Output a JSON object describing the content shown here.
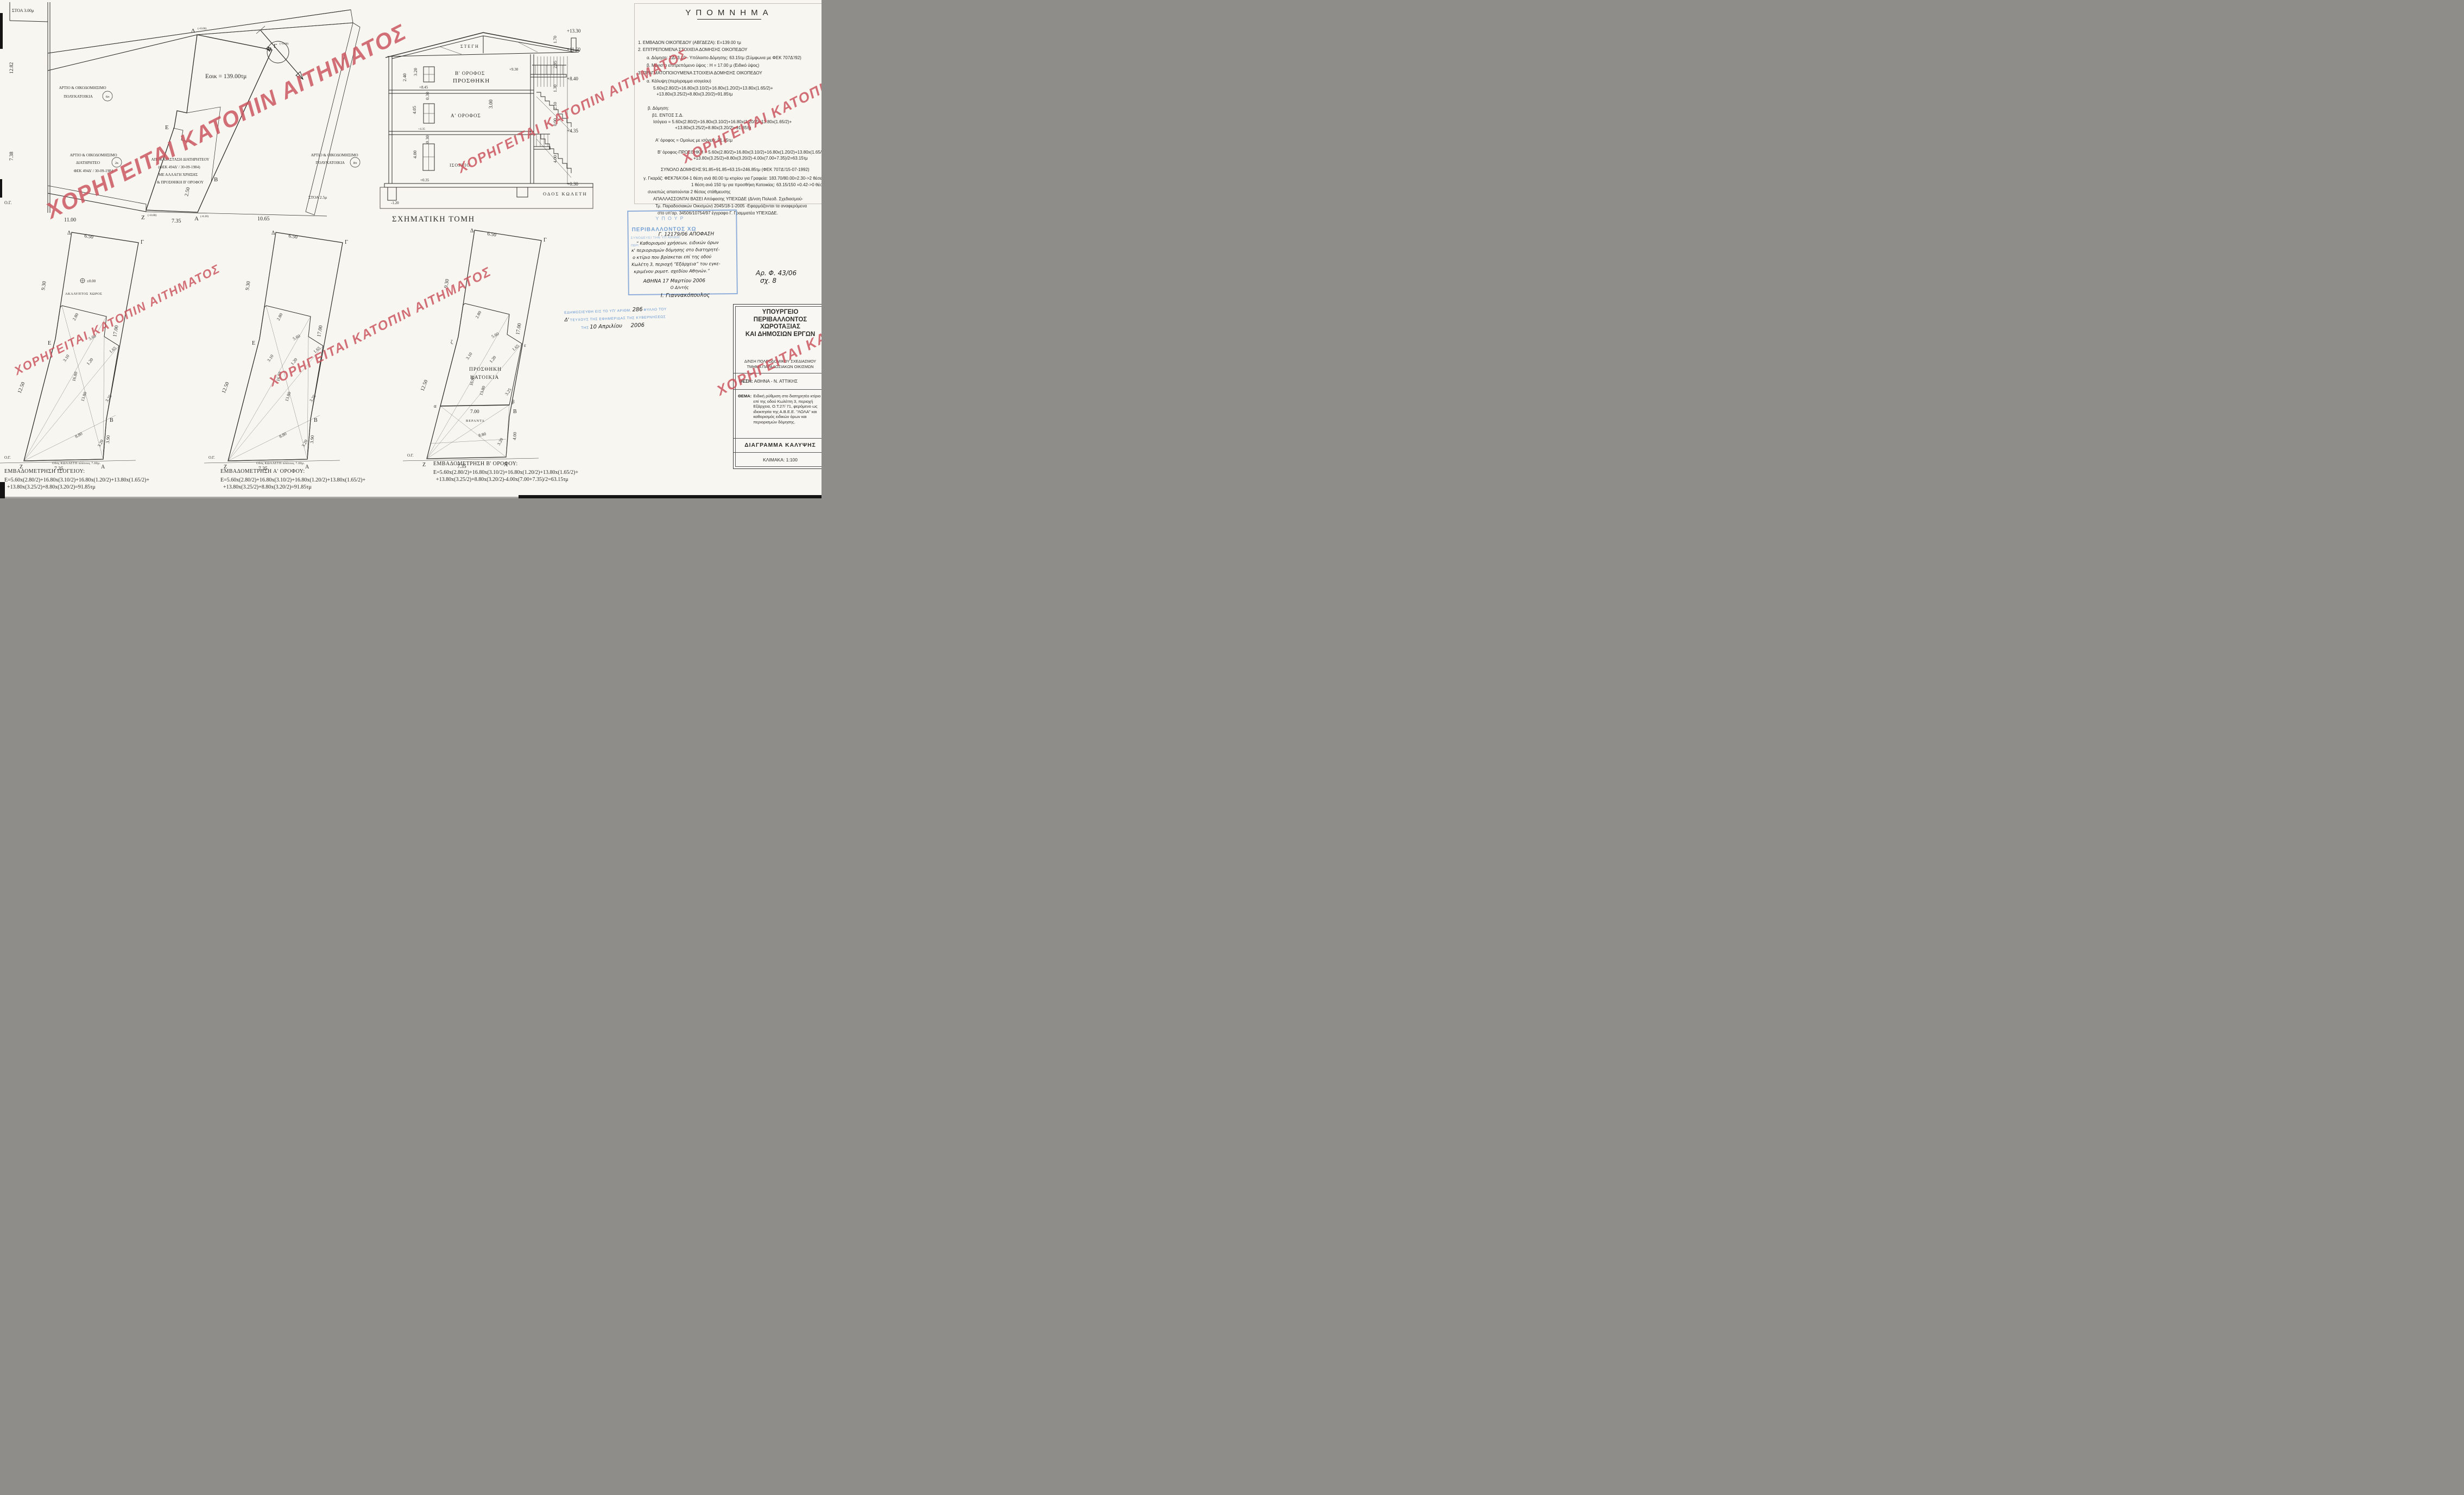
{
  "watermark": {
    "text": "ΧΟΡΗΓΕΙΤΑΙ ΚΑΤΟΠΙΝ ΑΙΤΗΜΑΤΟΣ",
    "color": "#c9515a"
  },
  "site_plan": {
    "stoa_top": "ΣΤΟΑ 3.00μ",
    "stoa_right": "ΣΤΟΑ 2.5μ",
    "building_line": "Ο.Γ.",
    "north": "Β",
    "area": "Εοικ = 139.00τμ",
    "dims": {
      "left_upper": "12.82",
      "left_lower": "7.38",
      "strip": "2.50",
      "bottom_left": "11.00",
      "bottom_mid": "7.35",
      "bottom_right": "10.65"
    },
    "corners": {
      "d": "Δ",
      "d_elev": "(+0.00)",
      "g": "Γ",
      "g_elev": "(+0.00)",
      "e": "Ε",
      "b": "Β",
      "z": "Ζ",
      "z_elev": "(+0.00)",
      "a": "Α",
      "a_elev": "(-0.20)"
    },
    "neighbor_top": {
      "l1": "ΑΡΤΙΟ & ΟΙΚΟΔΟΜΗΣΙΜΟ",
      "l2": "ΠΟΛΥΚΑΤΟΙΚΙΑ",
      "badge": "6π"
    },
    "neighbor_left": {
      "l1": "ΑΡΤΙΟ & ΟΙΚΟΔΟΜΗΣΙΜΟ",
      "l2": "ΔΙΑΤΗΡΗΤΕΟ",
      "badge": "2κ",
      "l3": "ΦΕΚ 494Δ' / 30-09-1984"
    },
    "neighbor_right": {
      "l1": "ΑΡΤΙΟ & ΟΙΚΟΔΟΜΗΣΙΜΟ",
      "l2": "ΠΟΛΥΚΑΤΟΙΚΙΑ",
      "badge": "8π"
    },
    "restoration": {
      "l1": "ΑΠΟΚΑΤΑΣΤΑΣΗ ΔΙΑΤΗΡΗΤΕΟΥ",
      "l2": "(ΦΕΚ 494Δ' / 30-09-1984)",
      "l3": "ΜΕ ΑΛΛΑΓΗ ΧΡΗΣΗΣ",
      "l4": "& ΠΡΟΣΘΗΚΗ Β' ΟΡΟΦΟΥ"
    }
  },
  "section": {
    "title": "ΣΧΗΜΑΤΙΚΗ ΤΟΜΗ",
    "roof": "ΣΤΕΓΗ",
    "floor2a": "Β' ΟΡΟΦΟΣ",
    "floor2b": "ΠΡΟΣΘΗΚΗ",
    "floor1": "Α' ΟΡΟΦΟΣ",
    "floor0": "ΙΣΟΓΕΙΟ",
    "street": "ΟΔΟΣ ΚΩΛΕΤΗ",
    "dims_left": [
      "2.40",
      "3.20",
      "0.30",
      "4.05",
      "0.30",
      "4.00"
    ],
    "elev_left": [
      "+8.45",
      "+4.35",
      "+0.35",
      "-1.20"
    ],
    "elev_right": [
      "+13.30",
      "+11.60",
      "+8.40",
      "+4.35",
      "+0.30"
    ],
    "dims_right": [
      "1.70",
      "2.95",
      "1.30",
      "2.10",
      "0.90",
      "4.00"
    ],
    "elev_stair": "+9.30",
    "dim_stair": "3.00"
  },
  "legend": {
    "title": "ΥΠΟΜΝΗΜΑ",
    "lines": [
      "1. ΕΜΒΑΔΟΝ ΟΙΚΟΠΕΔΟΥ (ΑΒΓΔΕΖΑ):   Ε=139.00 τμ",
      "2. ΕΠΙΤΡΕΠΟΜΕΝΑ ΣΤΟΙΧΕΙΑ ΔΟΜΗΣΗΣ ΟΙΚΟΠΕΔΟΥ",
      "α. Δόμηση: ΣΔ=3.10  - Υπόλοιπο Δόμησης: 63.15τμ (Σύμφωνα με ΦΕΚ 707Δ'/92)",
      "β. Μέγιστο επιτρεπόμενο ύψος : Η  = 17.00 μ (Ειδικό ύψος)",
      "3. ΠΡΑΓΜΑΤΟΠΟΙΟΥΜΕΝΑ ΣΤΟΙΧΕΙΑ ΔΟΜΗΣΗΣ ΟΙΚΟΠΕΔΟΥ",
      "α. Κάλυψη:(περίγραμμα ισογείου)",
      "5.60x(2.80/2)+16.80x(3.10/2)+16.80x(1.20/2)+13.80x(1.65/2)+",
      "+13.80x(3.25/2)+8.80x(3.20/2)=91.85τμ",
      "β. Δόμηση:",
      "β1. ΕΝΤΟΣ Σ.Δ.",
      "Ισόγειο = 5.60x(2.80/2)+16.80x(3.10/2)+16.80x(1.20/2)+13.80x(1.65/2)+",
      "+13.80x(3.25/2)+8.80x(3.20/2)=91.85τμ",
      "Α' όροφος = Ομοίως με ισόγειο:  91.85τμ",
      "Β' όροφος-ΠΡΟΣΘΗΚΗ = 5.60x(2.80/2)+16.80x(3.10/2)+16.80x(1.20/2)+13.80x(1.65/2)+",
      "+13.80x(3.25/2)+8.80x(3.20/2)-4.00x(7.00+7.35)/2=63.15τμ",
      "ΣΥΝΟΛΟ ΔΟΜΗΣΗΣ:91.85+91.85+63.15=246.85τμ   (ΦΕΚ 707Δ'/15-07-1992)",
      "γ. Γκαράζ: ΦΕΚ76Α'/04-1 θέση ανά 80.00 τμ κτιρίου για Γραφεία: 183.70/80.00=2.30->2 θέσεις",
      "1 θέση ανά 150 τμ για προσθήκη Κατοικίας: 63.15/150  =0.42->0 θέσεις",
      "συνεπώς απαιτούνται 2 θέσεις στάθμευσης",
      "ΑΠΑΛΛΑΣΣΟΝΤΑΙ ΒΑΣΕΙ Απόφασης ΥΠΕΧΩΔΕ (Δ/νση Πολεοδ. Σχεδιασμού-",
      "Τμ. Παραδοσιακών Οικισμών) 2045/18-1-2005 -Εφαρμόζονται τα αναφερόμενα",
      "στο υπ'αρ. 34506/10754/97 έγγραφο Γ. Γραμματέα ΥΠΕΧΩΔΕ."
    ]
  },
  "approval_stamp": {
    "printed": [
      "ΥΠΟΥΡ",
      "ΠΕΡΙΒΑΛΛΟΝΤΟΣ ΧΩ",
      "ΣΥΝΟΔΕΥΕΙ ΤΗΝ ΥΠ ΑΡΙΘΜ.",
      "ΠΕΡΙ"
    ],
    "hand": [
      "Γ. 12179/06 ΑΠΟΦΑΣΗ",
      "“ Καθορισμού χρήσεων, ειδικών όρων",
      "κ' περιορισμών δόμησης στο διατηρητέ-",
      "ο κτίριο που βρίσκεται επί της οδού",
      "Κωλέτη 3, περιοχή “Εξάρχεια” του εγκε-",
      "κριμένου ρυμοτ. σχεδίου Αθηνών.”",
      "ΑΘΗΝΑ 17 Μαρτίου 2006",
      "Ο Δ/ντής",
      "Ι. Γιαννακόπουλος"
    ]
  },
  "publication_stamp": {
    "printed": [
      "ΕΔΗΜΟΣΙΕΥΘΗ ΕΙΣ ΤΟ ΥΠ' ΑΡΙΘΜ.",
      "ΦΥΛΛΟ ΤΟΥ",
      "ΤΕΥΧΟΥΣ ΤΗΣ ΕΦΗΜΕΡΙΔΑΣ ΤΗΣ ΚΥΒΕΡΝΗΣΕΩΣ",
      "ΤΗΣ"
    ],
    "hand": [
      "286",
      "Δ'",
      "10 Απριλίου",
      "2006"
    ]
  },
  "file_note": {
    "l1": "Αρ. Φ. 43/06",
    "l2": "σχ. 8"
  },
  "title_block": {
    "ministry": [
      "ΥΠΟΥΡΓΕΙΟ",
      "ΠΕΡΙΒΑΛΛΟΝΤΟΣ",
      "ΧΩΡΟΤΑΞΙΑΣ",
      "ΚΑΙ ΔΗΜΟΣΙΩΝ ΕΡΓΩΝ"
    ],
    "department": [
      "Δ/ΝΣΗ ΠΟΛΕΟΔΟΜΙΚΟΥ ΣΧΕΔΙΑΣΜΟΥ",
      "ΤΜΗΜΑ ΠΑΡΑΔΟΣΙΑΚΩΝ ΟΙΚΙΣΜΩΝ"
    ],
    "location_label": "ΘΕΣΗ:",
    "location": "ΑΘΗΝΑ - Ν. ΑΤΤΙΚΗΣ",
    "subject_label": "ΘΕΜΑ:",
    "subject": "Ειδική ρύθμιση στο διατηρητέο κτίριο επί της οδού Κωλέττη 3, περιοχή Εξάρχεια, Ο.Τ.27/ 71, φερόμενο ως ιδιοκτησία της Α.Β.Ε.Ε. \"ΛΟΛΑ\" και καθορισμός ειδικών όρων και περιορισμών δόμησης.",
    "drawing_title": "ΔΙΑΓΡΑΜΜΑ  ΚΑΛΥΨΗΣ",
    "scale": "ΚΛΙΜΑΚΑ: 1:100"
  },
  "plan_dims": {
    "top": "6.50",
    "left_upper": "9.30",
    "right": "17.00",
    "left_lower": "12.50",
    "bottom": "7.35",
    "right_lower": "3.90",
    "seg_280": "2.80",
    "seg_560": "5.60",
    "seg_310": "3.10",
    "seg_120": "1.20",
    "seg_165": "1.65",
    "seg_1680": "16.80",
    "seg_1380": "13.80",
    "seg_325": "3.25",
    "seg_880": "8.80",
    "seg_320": "3.20"
  },
  "corners": {
    "d": "Δ",
    "g": "Γ",
    "e": "Ε",
    "b": "Β",
    "z": "Ζ",
    "a": "Α",
    "og": "Ο.Γ.",
    "alpha": "α",
    "beta": "β",
    "zeta": "ζ",
    "epsilon": "ε"
  },
  "plans": [
    {
      "title": "ΕΜΒΑΔΟΜΕΤΡΗΣΗ ΙΣΟΓΕΙΟΥ:",
      "formula1": "Ε=5.60x(2.80/2)+16.80x(3.10/2)+16.80x(1.20/2)+13.80x(1.65/2)+",
      "formula2": "+13.80x(3.25/2)+8.80x(3.20/2)=91.85τμ",
      "yard": "ΑΚΑΛΥΠΤΟΣ  ΧΩΡΟΣ",
      "yard_elev": "±0.00",
      "footnote": "Οδός ΚΩΛΛΕΤΗ πλάτους 7.00μ."
    },
    {
      "title": "ΕΜΒΑΔΟΜΕΤΡΗΣΗ  Α' ΟΡΟΦΟΥ:",
      "formula1": "Ε=5.60x(2.80/2)+16.80x(3.10/2)+16.80x(1.20/2)+13.80x(1.65/2)+",
      "formula2": "+13.80x(3.25/2)+8.80x(3.20/2)=91.85τμ",
      "footnote": "Οδός ΚΩΛΛΕΤΗ πλάτους 7.00μ."
    },
    {
      "title": "ΕΜΒΑΔΟΜΕΤΡΗΣΗ  Β' ΟΡΟΦΟΥ:",
      "formula1": "Ε=5.60x(2.80/2)+16.80x(3.10/2)+16.80x(1.20/2)+13.80x(1.65/2)+",
      "formula2": "+13.80x(3.25/2)+8.80x(3.20/2)-4.00x(7.00+7.35)/2=63.15τμ",
      "label1": "ΠΡΟΣΘΗΚΗ",
      "label2": "ΚΑΤΟΙΚΙΑ",
      "veranda": "ΒΕΡΑΝΤΑ",
      "width_dim": "7.00",
      "right_lower": "4.00"
    }
  ]
}
